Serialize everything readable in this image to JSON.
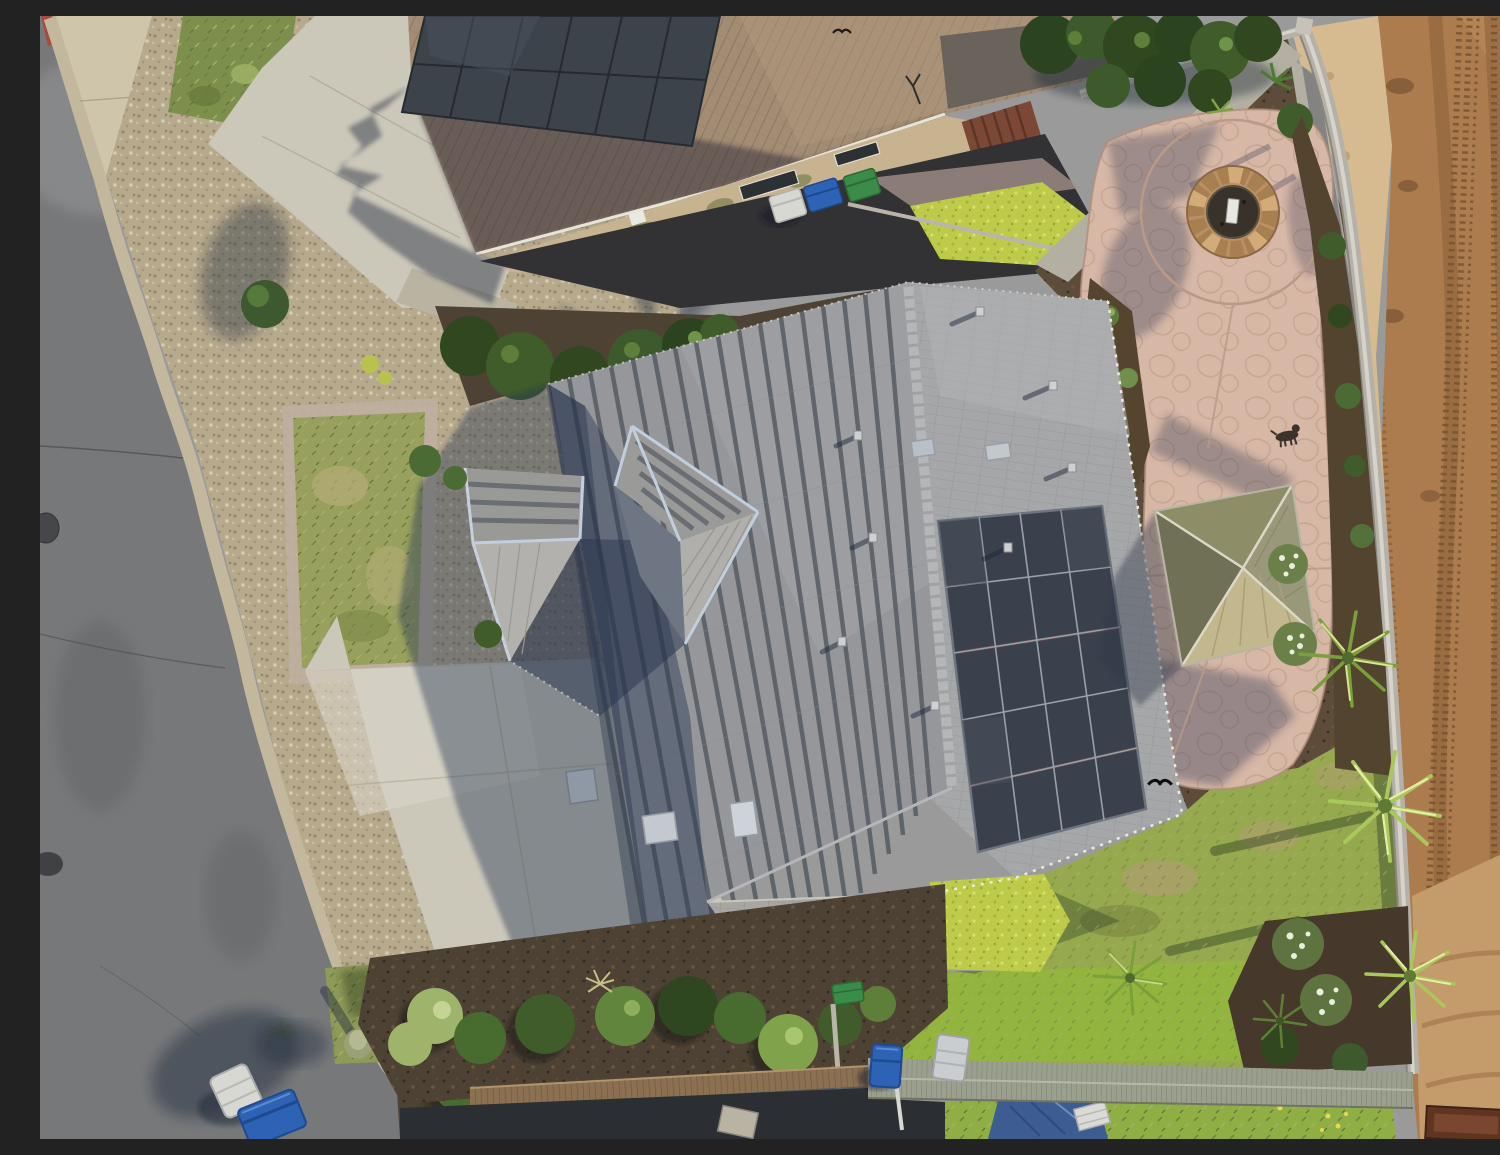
{
  "meta": {
    "title": "Aerial drone photograph: suburban corner-lot home with rooftop solar panels, stamped concrete fire-pit patio, gazebo and adjacent graded dirt field",
    "domain": "Natural-Image",
    "view": "top-down aerial, midday sun from the east casting shadows to the west",
    "dimensions": "1500x1123"
  },
  "scene": {
    "setting": "suburban residential neighborhood bordered by a graded dirt lot",
    "objects": [
      "asphalt street with curb, red-painted curb tip, storm drain grate and manhole covers",
      "tan concrete sidewalk with expansion joints",
      "front lawns bordered by rock gravel",
      "concrete driveways with tree and house shadows",
      "main house: gray flat-tile hip roof, ridge caps, batten lines, entry hip roofs with metal flashing, skylights, roof vents",
      "main house solar array: 4 columns x 5 rows of dark panels",
      "neighbor house: brown S-tile roof with 2x6 solar panel array, stucco wall, pergola, three wheeled trash bins (gray, blue, green)",
      "backyard stamped-concrete patio with circular stone fire pit ring",
      "olive hip-roof gazebo",
      "backyard lawn, partly dry, with palm trees and flowering shrubs",
      "gray concrete-block perimeter wall with light sand berm",
      "graded dirt field with tire tread tracks",
      "wood fence, corrugated patio awning, blue tarp, blue and gray wheeled bins",
      "small dog standing on patio path, two birds in flight"
    ]
  },
  "palette": {
    "street": "#77787a",
    "streetLight": "#8d8d8f",
    "streetDark": "#515254",
    "sidewalk": "#cfc5aa",
    "concrete": "#cbc7b9",
    "gravel": "#b7a98c",
    "grassFront": "#7c8f4c",
    "grassOlive": "#99a05e",
    "lawnBright": "#97a94e",
    "lime": "#becb4a",
    "mulch": "#4e4234",
    "bedMulch": "#5c4c39",
    "roofNeighbor": "#a38c74",
    "roofMain": "#95979b",
    "roofMainLit": "#a6a7a9",
    "batten": "#585d64",
    "ridgeCap": "#b5b6b7",
    "flashing": "#c2cedd",
    "solar": "#3a414d",
    "solarNeighbor": "#3c434b",
    "patio": "#d7b7a6",
    "patioStone": "#c09e8b",
    "firepitStone": "#b98f63",
    "firepitInner": "#39322a",
    "gazeboTop": "#8d8e68",
    "gazeboEast": "#99987a",
    "gazeboSouth": "#c3b78e",
    "gazeboWest": "#6f7056",
    "wall": "#b5b1a8",
    "wallCap": "#d6d3cb",
    "sand": "#d6ba90",
    "dirt": "#ac7c4e",
    "dirtTrack": "#8a5f39",
    "dirtLight": "#c49c6c",
    "woodFence": "#8b7052",
    "awning": "#9ba08e",
    "alley": "#2b2f33",
    "tarp": "#3d5c92",
    "planter": "#5f3522",
    "binBlue": "#2e62b4",
    "binGreen": "#3c8c49",
    "binWhite": "#d8d8d3",
    "hedgeDark": "#31471f",
    "bushGreen": "#486b2f",
    "palmGreen": "#7ba03b",
    "palmLight": "#d7e491",
    "shadow": "rgba(38,52,80,0.42)",
    "redCurb": "#a84a3c"
  }
}
